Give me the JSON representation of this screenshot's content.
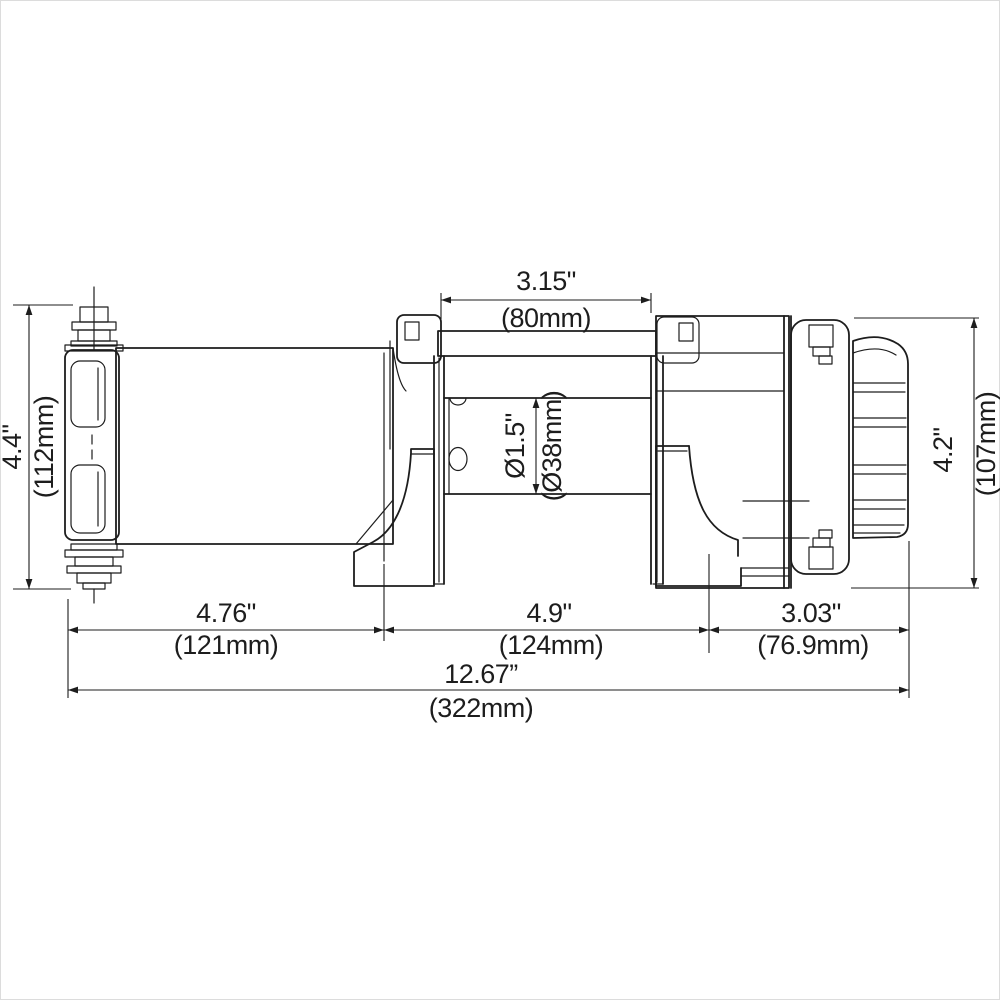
{
  "meta": {
    "description": "Dimensional line drawing of an electric winch (side view): motor, rope drum, tie bar, mounting feet, gearbox with clutch knob",
    "units": "inches with millimetre equivalents"
  },
  "colors": {
    "line": "#1d1d1d",
    "background": "#ffffff"
  },
  "dims": {
    "drum_width": {
      "in": "3.15\"",
      "mm": "(80mm)"
    },
    "motor_height": {
      "in": "4.4\"",
      "mm": "(112mm)"
    },
    "gear_height": {
      "in": "4.2\"",
      "mm": "(107mm)"
    },
    "drum_dia": {
      "in": "Ø1.5\"",
      "mm": "(Ø38mm)"
    },
    "motor_length": {
      "in": "4.76\"",
      "mm": "(121mm)"
    },
    "drum_length": {
      "in": "4.9\"",
      "mm": "(124mm)"
    },
    "gear_length": {
      "in": "3.03\"",
      "mm": "(76.9mm)"
    },
    "overall": {
      "in": "12.67”",
      "mm": "(322mm)"
    }
  }
}
